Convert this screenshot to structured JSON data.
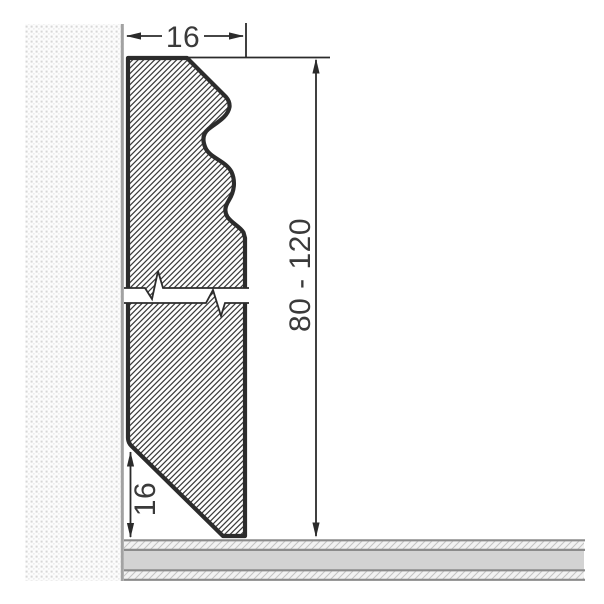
{
  "drawing": {
    "type": "technical-cross-section",
    "subject": "skirting board profile mounted on wall above floor",
    "labels": {
      "top_width": "16",
      "height_range": "80 - 120",
      "bottom_bevel_height": "16"
    },
    "colors": {
      "background": "#ffffff",
      "profile_outline": "#2c2c2c",
      "profile_hatch_line": "#3c3c3c",
      "wall_dot": "#d7d7d7",
      "wall_edge_line": "#a2a2a2",
      "floor_border": "#8b8b8b",
      "floor_core_fill": "#d3d3d3",
      "floor_hatch_bg": "#f2f2f2",
      "dimension_line": "#2b2b2b",
      "dimension_text": "#3a3a3a"
    },
    "parts": [
      {
        "name": "wall",
        "texture": "stipple-dots"
      },
      {
        "name": "skirting-profile-upper-section",
        "texture": "diagonal-hatch"
      },
      {
        "name": "skirting-profile-lower-section",
        "texture": "diagonal-hatch"
      },
      {
        "name": "floor",
        "texture": "layered-screed"
      }
    ]
  }
}
